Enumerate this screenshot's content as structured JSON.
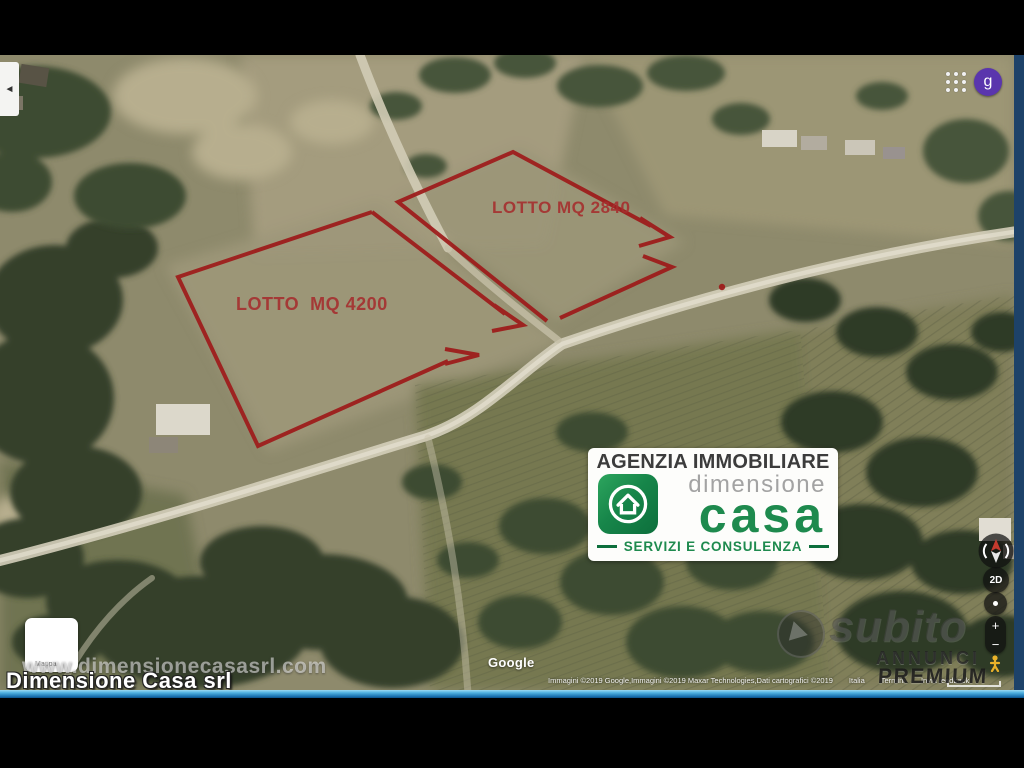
{
  "annotations": {
    "lot1_label": "LOTTO MQ 2840",
    "lot2_label": "LOTTO  MQ 4200"
  },
  "agency_card": {
    "title": "AGENZIA IMMOBILIARE",
    "brand_top": "dimensione",
    "brand_main": "casa",
    "tagline": "SERVIZI E CONSULENZA"
  },
  "watermarks": {
    "website": "www.dimensionecasasrl.com",
    "company": "Dimensione Casa srl",
    "subito": "subito",
    "annunci": "ANNUNCI",
    "premium": "PREMIUM"
  },
  "google_ui": {
    "logo": "Google",
    "attribution": "Immagini ©2019 Google,Immagini ©2019 Maxar Technologies,Dati cartografici ©2019",
    "region": "Italia",
    "terms": "Termini",
    "feedback": "Invia feedback",
    "map_thumb_label": "Mappa",
    "account_letter": "g"
  },
  "controls": {
    "mode_2d": "2D",
    "zoom_in": "+",
    "zoom_out": "−",
    "back_arrow": "◄"
  },
  "colors": {
    "lot_outline": "#9e1a1a",
    "lot_text": "#a62f2f",
    "brand_green": "#1e8a4e",
    "avatar_purple": "#5a35ad",
    "bottom_bar_blue": "#1a72b0",
    "right_strip_navy": "#1d4269"
  }
}
